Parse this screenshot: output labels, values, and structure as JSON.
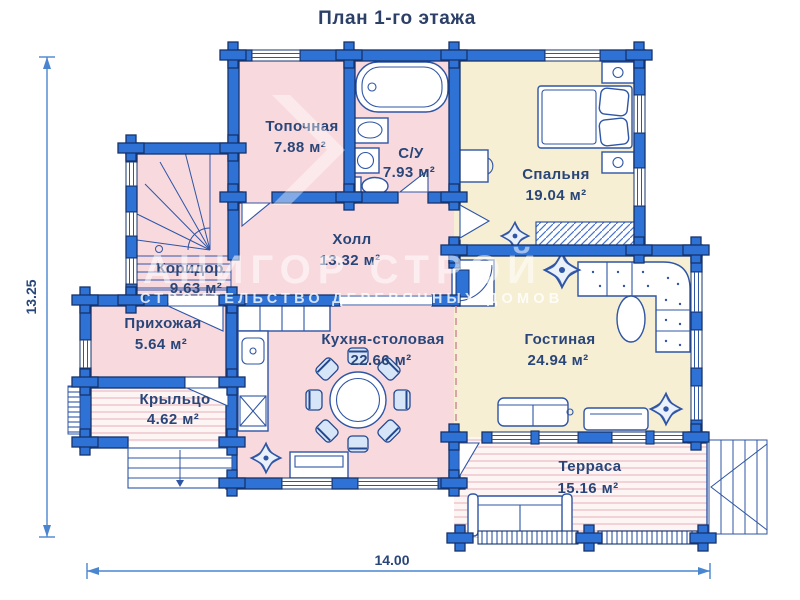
{
  "title": "План 1-го этажа",
  "watermark": {
    "brand": "АНИГОР СТРОЙ",
    "tagline": "СТРОИТЕЛЬСТВО ДЕРЕВЯННЫХ ДОМОВ"
  },
  "dimensions": {
    "height_label": "13.25",
    "width_label": "14.00"
  },
  "rooms": {
    "topochnaya": {
      "name": "Топочная",
      "area": "7.88 м²"
    },
    "su": {
      "name": "С/У",
      "area": "7.93 м²"
    },
    "spalnya": {
      "name": "Спальня",
      "area": "19.04 м²"
    },
    "holl": {
      "name": "Холл",
      "area": "13.32 м²"
    },
    "koridor": {
      "name": "Коридор",
      "area": "9.63 м²"
    },
    "prihozhaya": {
      "name": "Прихожая",
      "area": "5.64 м²"
    },
    "kuhnya": {
      "name": "Кухня-столовая",
      "area": "22.66 м²"
    },
    "gostinaya": {
      "name": "Гостиная",
      "area": "24.94 м²"
    },
    "kryltso": {
      "name": "Крыльцо",
      "area": "4.62 м²"
    },
    "terrasa": {
      "name": "Терраса",
      "area": "15.16 м²"
    }
  },
  "colors": {
    "wall": "#2e72d6",
    "wall_outline": "#16336b",
    "room_pink": "#f8dade",
    "room_cream": "#f6efd3",
    "label_navy": "#2a4679"
  }
}
